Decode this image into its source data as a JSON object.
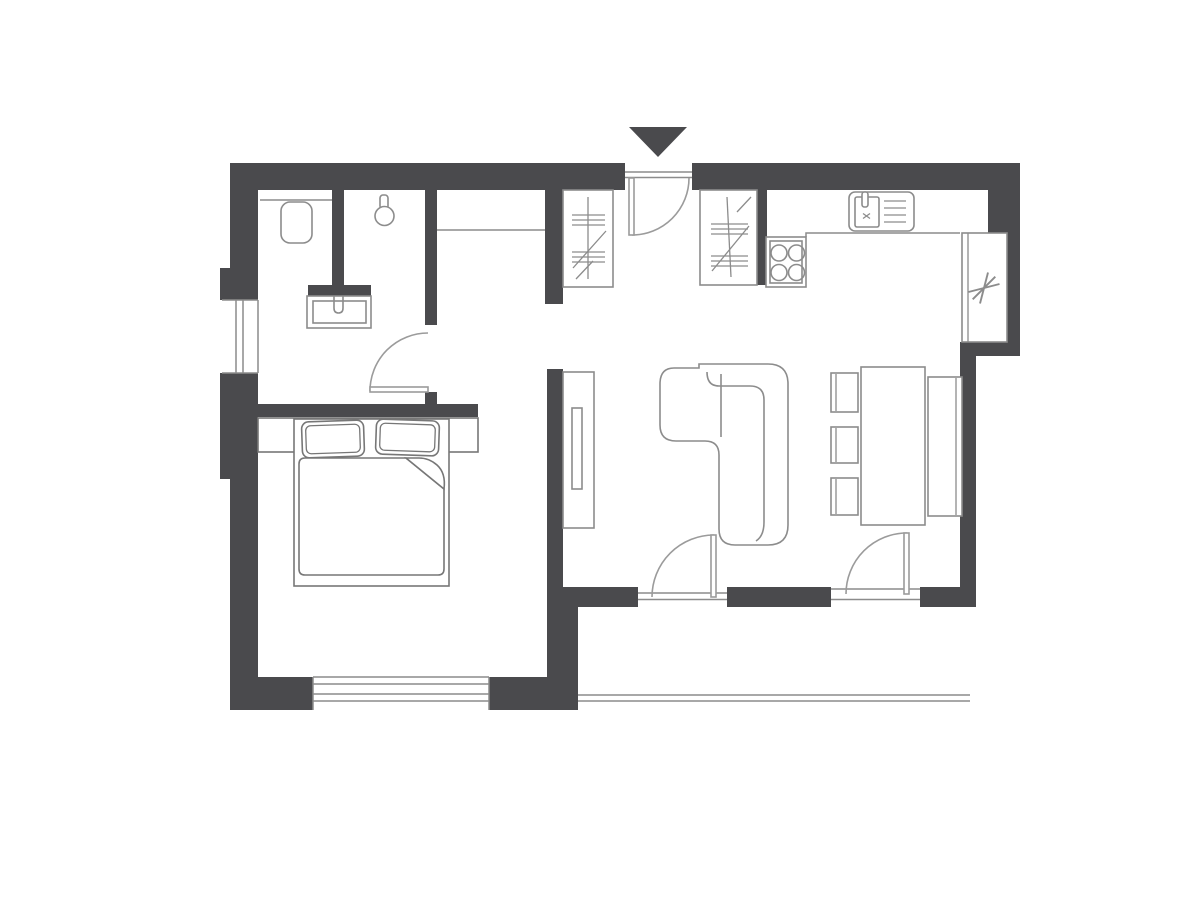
{
  "meta": {
    "title": "Apartment floor plan",
    "drawing_type": "architectural floor plan, top-down 2D line drawing",
    "theme": "dark gray walls, light gray furniture outlines on white"
  },
  "colors": {
    "background": "#ffffff",
    "wall": "#4a4a4d",
    "thin_line": "#8c8c8c",
    "furniture_line": "#8c8c8c",
    "bed_line": "#777777",
    "door_line": "#9b9b9b",
    "entrance_marker": "#4a4a4d"
  },
  "rooms": [
    {
      "name": "bathroom",
      "position": "top-left",
      "fixtures": [
        "wall-hung-toilet",
        "shower-head",
        "washbasin-vanity",
        "partition-wall",
        "west-window"
      ]
    },
    {
      "name": "hallway",
      "position": "top-center",
      "fixtures": [
        "entrance-door",
        "wardrobe-closet-hatched",
        "niche-line"
      ]
    },
    {
      "name": "kitchen",
      "position": "top-right",
      "fixtures": [
        "wardrobe-closet-hatched",
        "stove-four-burners",
        "sink-with-drainboard",
        "worktop-counter",
        "refrigerator-asterisk-symbol"
      ]
    },
    {
      "name": "bedroom",
      "position": "bottom-left",
      "fixtures": [
        "double-bed",
        "two-pillows",
        "duvet-with-folded-corner",
        "headboard-shelf",
        "south-window",
        "open-doorway"
      ]
    },
    {
      "name": "living-dining-room",
      "position": "right",
      "fixtures": [
        "corner-sofa",
        "tv-sideboard",
        "dining-table",
        "three-chairs",
        "bench",
        "balcony-door-left",
        "balcony-door-right-with-window"
      ]
    },
    {
      "name": "terrace",
      "position": "bottom-right-outside",
      "fixtures": [
        "terrace-edge-line"
      ]
    }
  ],
  "doors": [
    {
      "id": "entrance-door",
      "type": "single-swing",
      "opens": "inward into hallway, hinge left"
    },
    {
      "id": "bathroom-door",
      "type": "single-swing",
      "opens": "into bathroom"
    },
    {
      "id": "balcony-door-left",
      "type": "single-swing",
      "opens": "into living room, hinge right"
    },
    {
      "id": "balcony-door-right",
      "type": "single-swing",
      "opens": "into living room, hinge right, fixed glazing beside"
    }
  ],
  "windows": [
    "bathroom-west-window",
    "bedroom-south-window",
    "living-room-south-glazing"
  ],
  "marker": {
    "shape": "filled triangle pointing down",
    "meaning": "entrance indicator above entrance door"
  }
}
